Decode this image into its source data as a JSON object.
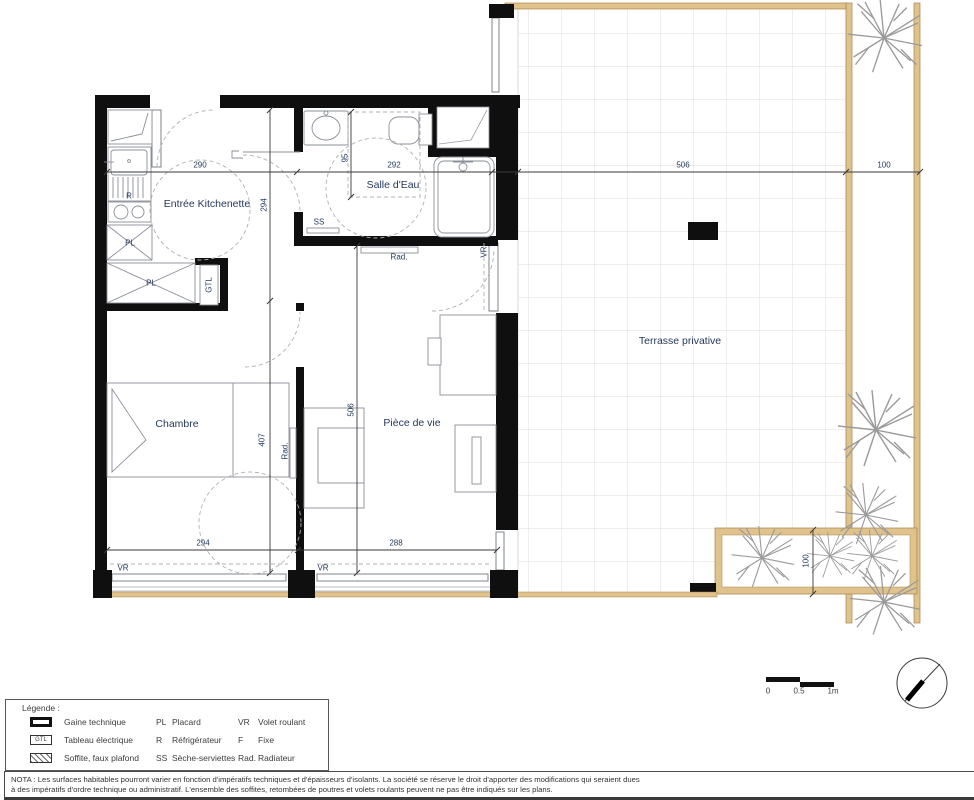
{
  "colors": {
    "wall": "#0f0f0f",
    "label_text": "#24395a",
    "terrace_border": "#dfc28c",
    "terrace_grid": "#dcdcdc",
    "fixture_line": "#8a8f98",
    "legend_text": "#3c3c3c"
  },
  "rooms": {
    "entree": "Entrée Kitchenette",
    "salle_eau": "Salle d'Eau",
    "chambre": "Chambre",
    "piece_de_vie": "Pièce de vie",
    "terrasse": "Terrasse privative"
  },
  "dims": {
    "entree_width": "290",
    "salle_eau_width": "292",
    "soffit_depth": "95",
    "entree_depth": "294",
    "chambre_depth": "407",
    "piece_depth": "506",
    "chambre_width": "294",
    "piece_width": "288",
    "terrasse_width": "506",
    "strip_width": "100",
    "bed_height": "100"
  },
  "tags": {
    "pl_upper": "PL",
    "pl_lower": "PL",
    "gtl": "GTL",
    "fridge": "R",
    "towel_dryer": "SS",
    "rad_hall": "Rad.",
    "rad_chambre": "Rad.",
    "vr_chambre": "VR",
    "vr_piece": "VR",
    "vr_right": "VR"
  },
  "scale_bar": {
    "zero": "0",
    "half": "0.5",
    "one": "1m"
  },
  "legend": {
    "title": "Légende :",
    "rows": [
      {
        "desc": "Gaine technique",
        "abbr2": "PL",
        "label2": "Placard",
        "abbr3": "VR",
        "label3": "Volet roulant"
      },
      {
        "desc": "Tableau électrique",
        "icon_text": "GTL",
        "abbr2": "R",
        "label2": "Réfrigérateur",
        "abbr3": "F",
        "label3": "Fixe"
      },
      {
        "desc": "Soffite, faux plafond",
        "abbr2": "SS",
        "label2": "Sèche-serviettes",
        "abbr3": "Rad.",
        "label3": "Radiateur"
      }
    ]
  },
  "nota": {
    "line1": "NOTA : Les surfaces habitables pourront varier en fonction d'impératifs techniques et d'épaisseurs d'isolants. La société se réserve le droit d'apporter des modifications qui seraient dues",
    "line2": "à des impératifs d'ordre technique ou administratif. L'ensemble des soffites, retombées de poutres et volets roulants peuvent ne pas être indiqués sur les plans."
  }
}
